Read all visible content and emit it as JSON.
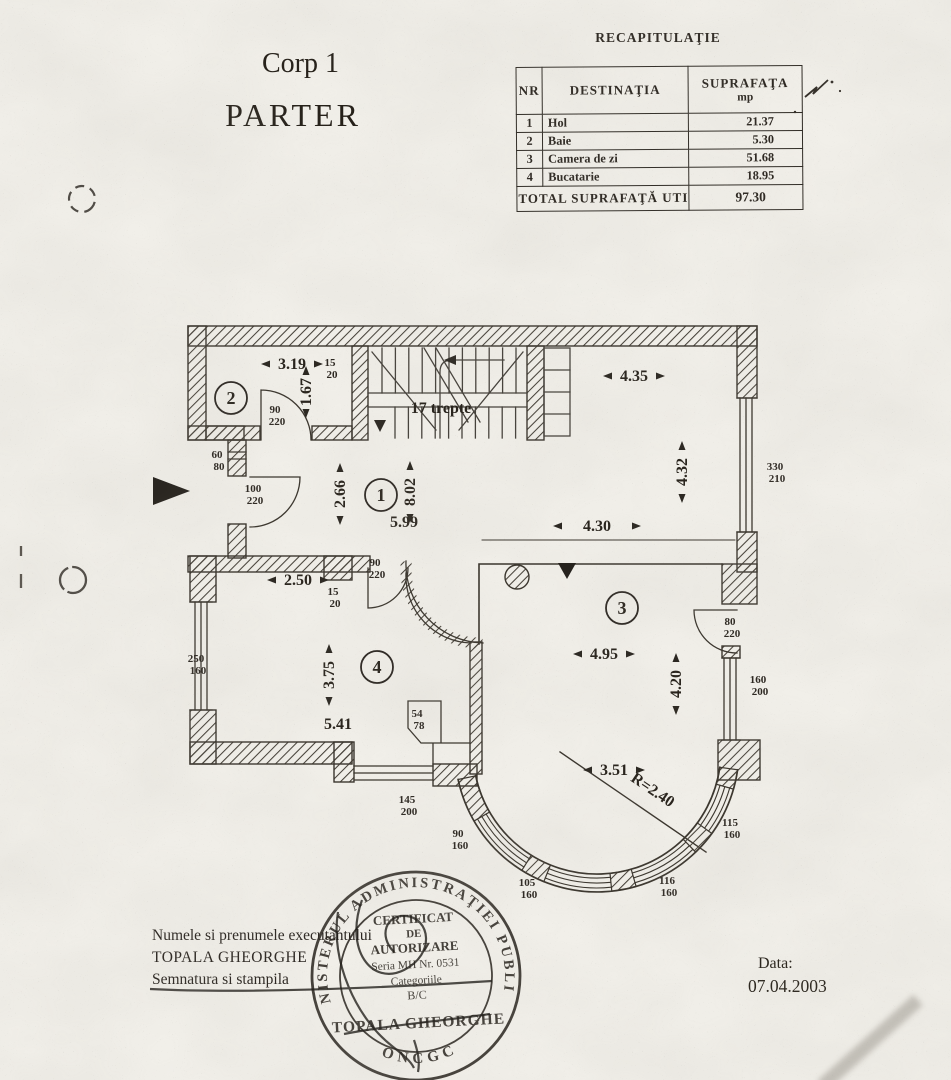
{
  "page": {
    "title_line1": "Corp 1",
    "title_line2": "PARTER",
    "date_label": "Data:",
    "date_value": "07.04.2003"
  },
  "recap": {
    "title": "RECAPITULAŢIE",
    "col_nr": "NR",
    "col_dest": "DESTINAŢIA",
    "col_supr": "SUPRAFAŢA",
    "col_unit": "mp",
    "rows": [
      {
        "nr": "1",
        "dest": "Hol",
        "mp": "21.37"
      },
      {
        "nr": "2",
        "dest": "Baie",
        "mp": "5.30"
      },
      {
        "nr": "3",
        "dest": "Camera de zi",
        "mp": "51.68"
      },
      {
        "nr": "4",
        "dest": "Bucatarie",
        "mp": "18.95"
      }
    ],
    "total_label": "TOTAL SUPRAFAŢĂ UTILĂ",
    "total_value": "97.30"
  },
  "executor": {
    "caption": "Numele si prenumele executantului",
    "name": "TOPALA GHEORGHE",
    "signature_caption": "Semnatura si stampila"
  },
  "stamp": {
    "ring": "MINISTERUL ADMINISTRAŢIEI PUBLICE",
    "ring_bottom": "ONCGC",
    "l1": "CERTIFICAT",
    "l2": "DE",
    "l3": "AUTORIZARE",
    "l4": "Seria MH Nr. 0531",
    "l5": "Categoriile",
    "l6": "B/C",
    "name": "TOPALA GHEORGHE"
  },
  "plan": {
    "rooms": [
      "1",
      "2",
      "3",
      "4"
    ],
    "stair_note": "17 trepte",
    "radius_note": "R=2.40",
    "dims": {
      "room2_w": "3.19",
      "room2_h": "1.67",
      "top_right_w": "4.35",
      "right_h": "4.32",
      "hall_left_h": "2.66",
      "hall_h": "8.02",
      "hall_w": "5.99",
      "hall_right_w": "4.30",
      "kitchen_top_w": "2.50",
      "kitchen_h": "3.75",
      "kitchen_w": "5.41",
      "living_w": "4.95",
      "living_h": "4.20",
      "bay_w": "3.51"
    },
    "openings": {
      "stair_pier": [
        "15",
        "20"
      ],
      "room2_door": [
        "90",
        "220"
      ],
      "small_window": [
        "60",
        "80"
      ],
      "entry_door": [
        "100",
        "220"
      ],
      "hall_door": [
        "90",
        "220"
      ],
      "kitchen_pier": [
        "15",
        "20"
      ],
      "kitchen_window_left": [
        "250",
        "160"
      ],
      "shaft": [
        "54",
        "78"
      ],
      "kitchen_window_bottom": [
        "145",
        "200"
      ],
      "window_right_upper": [
        "330",
        "210"
      ],
      "living_door": [
        "80",
        "220"
      ],
      "living_window_right": [
        "160",
        "200"
      ],
      "bay_window_1": [
        "90",
        "160"
      ],
      "bay_window_2": [
        "105",
        "160"
      ],
      "bay_window_3": [
        "116",
        "160"
      ],
      "bay_window_4": [
        "115",
        "160"
      ]
    }
  }
}
